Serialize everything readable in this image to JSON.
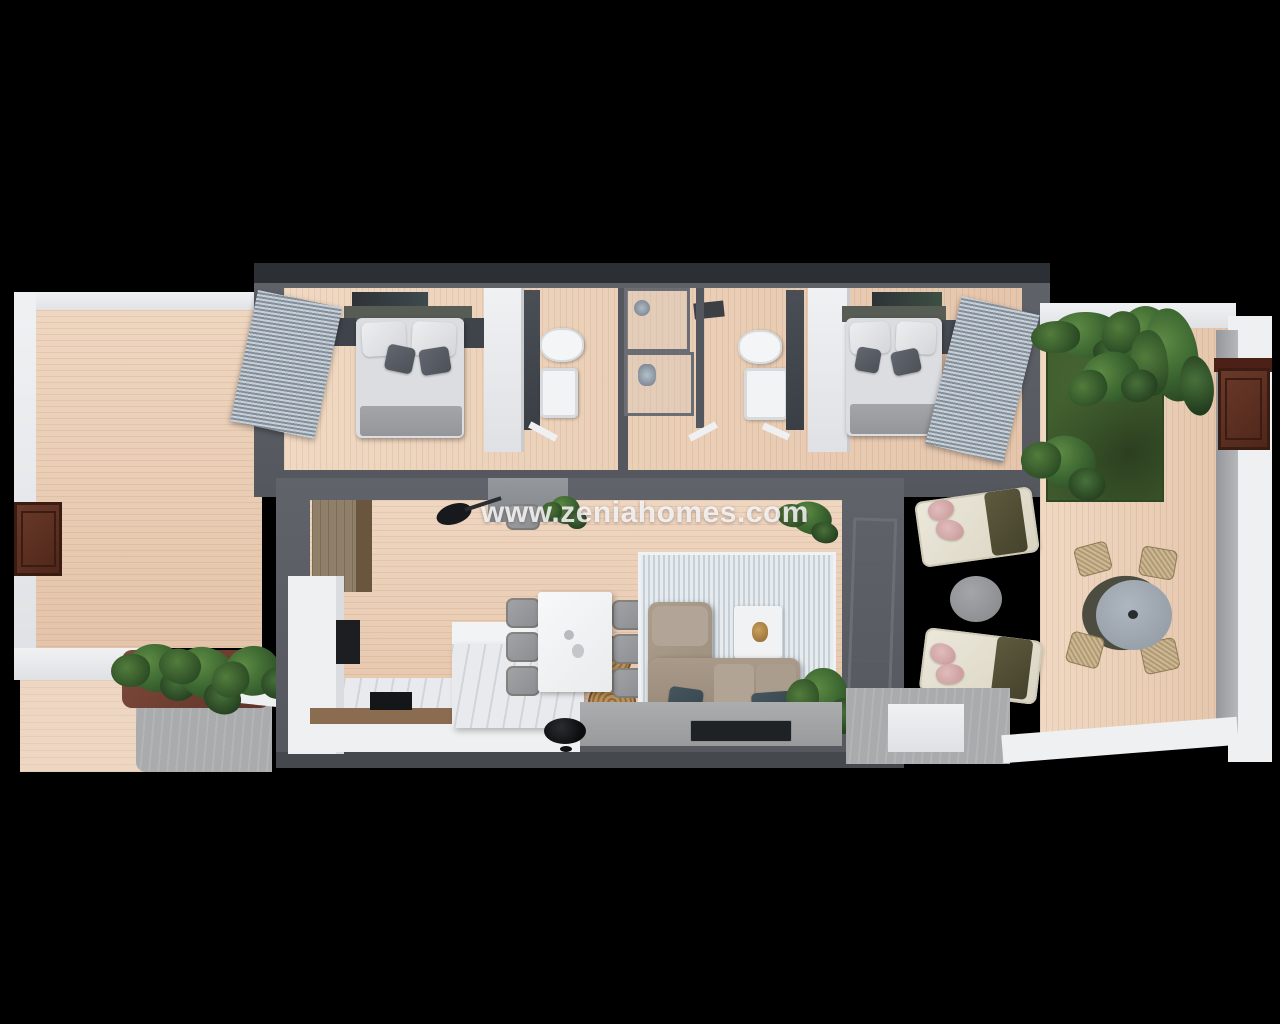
{
  "watermark": {
    "text": "www.zeniahomes.com"
  },
  "palette": {
    "background": "#000000",
    "wood_floor": "#e9cdb6",
    "wall_dark": "#5a5d63",
    "wall_white": "#eceef0",
    "grass_green": "#3e5a2d",
    "plant_green": "#3f6a33",
    "door_brown": "#5d3226",
    "sofa_taupe": "#a69786",
    "cushion_teal": "#3e4e57",
    "rug_gray_blue": "#e6eaed",
    "blind_gray": "#aeb9c4",
    "pillow_pink": "#d7a9a9",
    "blanket_olive": "#55523a",
    "marble_white": "#eff0f2",
    "appliance_black": "#17191c",
    "path_gray": "#a8aaac"
  }
}
